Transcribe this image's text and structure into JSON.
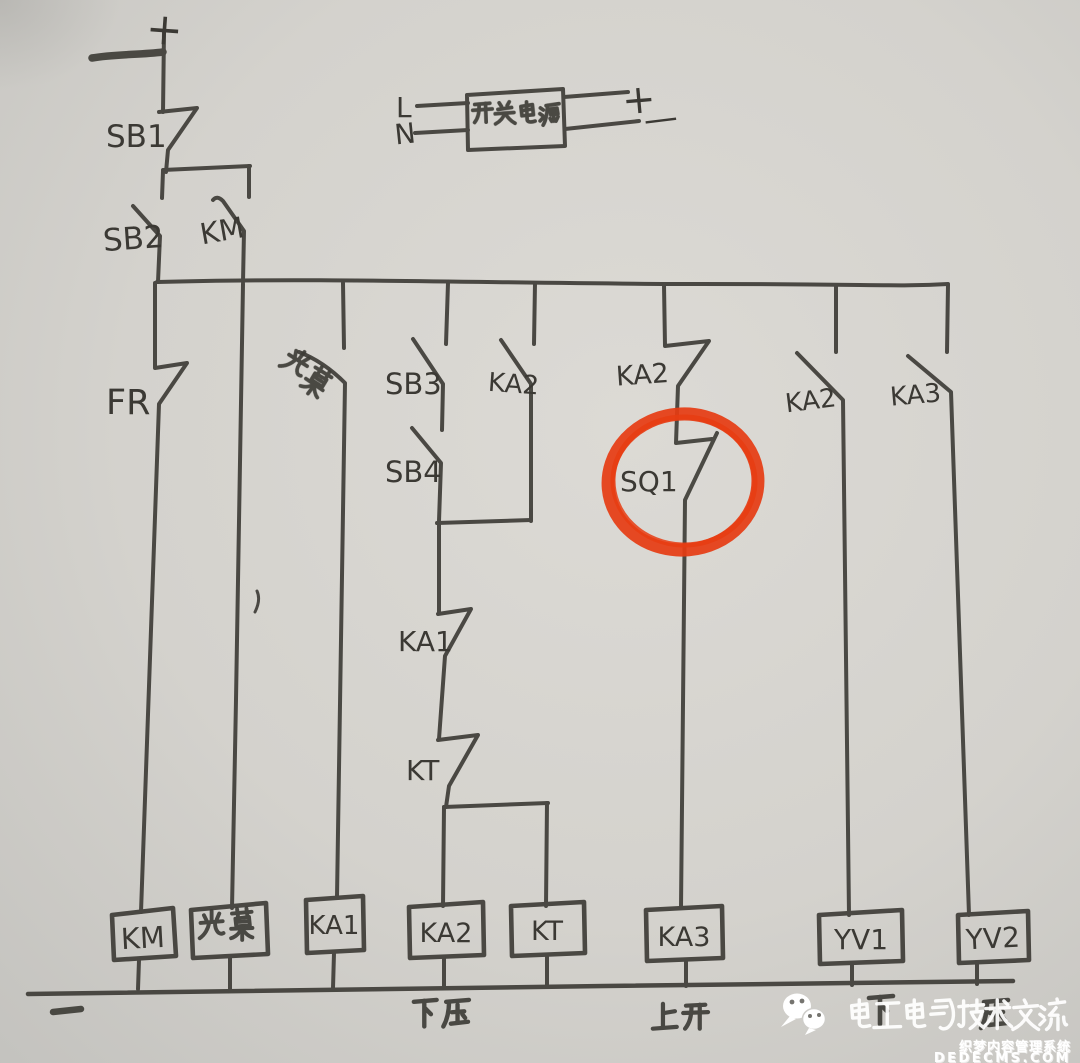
{
  "labels": {
    "polarity_plus_top": "+",
    "psu_l": "L",
    "psu_n": "N",
    "psu_name": "开关电源",
    "psu_plus": "+",
    "psu_minus": "—",
    "sb1": "SB1",
    "sb2": "SB2",
    "km": "KM",
    "fr": "FR",
    "light_curtain": "光幕",
    "sb3": "SB3",
    "sb4": "SB4",
    "ka2_parallel": "KA2",
    "ka2_nc": "KA2",
    "sq1": "SQ1",
    "ka1": "KA1",
    "kt": "KT",
    "ka2_right": "KA2",
    "ka3_right": "KA3",
    "coil_km": "KM",
    "coil_light_curtain": "光幕",
    "coil_ka1": "KA1",
    "coil_ka2": "KA2",
    "coil_kt": "KT",
    "coil_ka3": "KA3",
    "coil_yv1": "YV1",
    "coil_yv2": "YV2",
    "minus_bottom": "一",
    "down_press": "下压",
    "up_open": "上开",
    "down_press_hidden": "下压"
  },
  "highlight": {
    "target": "SQ1",
    "color": "#e63c12"
  },
  "watermark": {
    "wechat": "电工电气技术交流",
    "cms": "织梦内容管理系统",
    "site": "DEDECMS.COM"
  }
}
